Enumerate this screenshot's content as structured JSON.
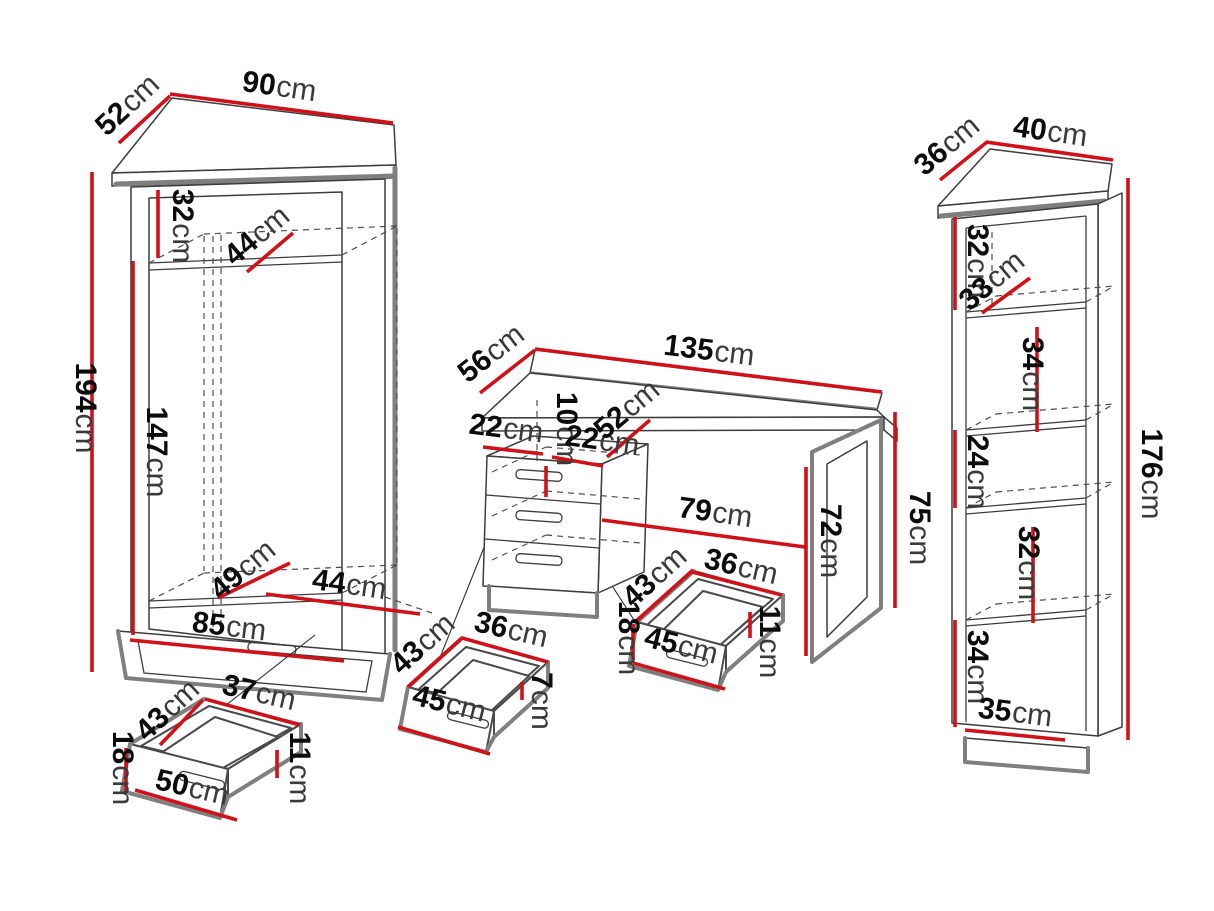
{
  "colors": {
    "dimension_red": "#d01117",
    "edge_gray": "#7f7f7f",
    "line_dark": "#3d3d3d",
    "background": "#ffffff"
  },
  "unit": "cm",
  "dims": {
    "wardrobe_depth": {
      "num": "52",
      "unit": "cm"
    },
    "wardrobe_width": {
      "num": "90",
      "unit": "cm"
    },
    "wardrobe_top_section": {
      "num": "32",
      "unit": "cm"
    },
    "wardrobe_top_shelf": {
      "num": "44",
      "unit": "cm"
    },
    "wardrobe_height": {
      "num": "194",
      "unit": "cm"
    },
    "wardrobe_inner_height": {
      "num": "147",
      "unit": "cm"
    },
    "wardrobe_bottom_shelf_depth": {
      "num": "49",
      "unit": "cm"
    },
    "wardrobe_bottom_shelf_width": {
      "num": "44",
      "unit": "cm"
    },
    "wardrobe_bottom_width": {
      "num": "85",
      "unit": "cm"
    },
    "wdrawer_depth": {
      "num": "43",
      "unit": "cm"
    },
    "wdrawer_top_width": {
      "num": "37",
      "unit": "cm"
    },
    "wdrawer_front_height": {
      "num": "18",
      "unit": "cm"
    },
    "wdrawer_width": {
      "num": "50",
      "unit": "cm"
    },
    "wdrawer_side_height": {
      "num": "11",
      "unit": "cm"
    },
    "desk_depth": {
      "num": "56",
      "unit": "cm"
    },
    "desk_width": {
      "num": "135",
      "unit": "cm"
    },
    "desk_seg_left": {
      "num": "22",
      "unit": "cm"
    },
    "desk_drawer_front": {
      "num": "10",
      "unit": "cm"
    },
    "desk_seg_right": {
      "num": "22",
      "unit": "cm"
    },
    "desk_cab_depth": {
      "num": "52",
      "unit": "cm"
    },
    "desk_clear_width": {
      "num": "79",
      "unit": "cm"
    },
    "desk_clear_height": {
      "num": "72",
      "unit": "cm"
    },
    "desk_height": {
      "num": "75",
      "unit": "cm"
    },
    "ddrawer1_depth": {
      "num": "43",
      "unit": "cm"
    },
    "ddrawer1_top_width": {
      "num": "36",
      "unit": "cm"
    },
    "ddrawer1_width": {
      "num": "45",
      "unit": "cm"
    },
    "ddrawer1_side_height": {
      "num": "7",
      "unit": "cm"
    },
    "ddrawer2_depth": {
      "num": "43",
      "unit": "cm"
    },
    "ddrawer2_top_width": {
      "num": "36",
      "unit": "cm"
    },
    "ddrawer2_front_height": {
      "num": "18",
      "unit": "cm"
    },
    "ddrawer2_width": {
      "num": "45",
      "unit": "cm"
    },
    "ddrawer2_side_height": {
      "num": "11",
      "unit": "cm"
    },
    "shelf_depth": {
      "num": "36",
      "unit": "cm"
    },
    "shelf_width": {
      "num": "40",
      "unit": "cm"
    },
    "shelf_section1": {
      "num": "32",
      "unit": "cm"
    },
    "shelf_shelf_depth": {
      "num": "33",
      "unit": "cm"
    },
    "shelf_section2": {
      "num": "34",
      "unit": "cm"
    },
    "shelf_section3": {
      "num": "24",
      "unit": "cm"
    },
    "shelf_section4": {
      "num": "32",
      "unit": "cm"
    },
    "shelf_section5": {
      "num": "34",
      "unit": "cm"
    },
    "shelf_bottom_width": {
      "num": "35",
      "unit": "cm"
    },
    "shelf_height": {
      "num": "176",
      "unit": "cm"
    }
  }
}
